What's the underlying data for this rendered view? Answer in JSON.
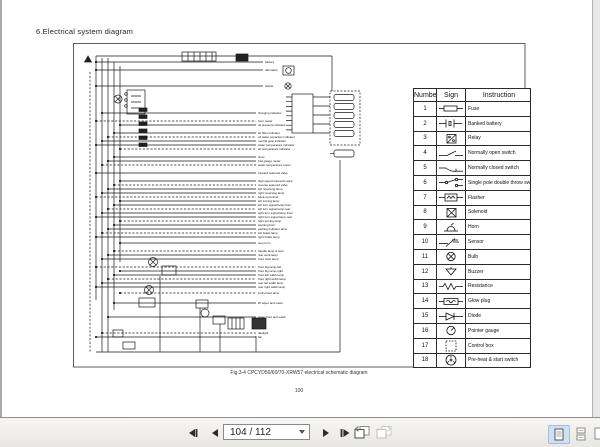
{
  "page": {
    "section_title": "6.Electrical system diagram",
    "caption": "Fig.3-4 CPCYD50/60/70-XRW57 electrical schematic diagram",
    "page_number": "100"
  },
  "diagram": {
    "labels": [
      "battery",
      "alternator",
      "starter",
      "charging indicator",
      "hour meter",
      "oil pressure indicator",
      "air filter indicator",
      "oil water separator indicator",
      "neutral gear indicator",
      "water temperature indicator",
      "air temperature indicator",
      "timer",
      "fuel gauge meter",
      "water temperature meter",
      "forward solenoid valve",
      "high speed solenoid valve",
      "reverse solenoid valve",
      "left reversing lamp",
      "right reversing lamp",
      "back-up buzzer",
      "left turning lamp",
      "left turn signal lamp-front",
      "left turn signal lamp-rear",
      "right turn signal lamp-front",
      "right turn signal lamp-rear",
      "right turning lamp",
      "warning horn",
      "parking indicator lamp",
      "left brake lamp",
      "right brake lamp",
      "stop horn",
      "handle lamp & horn",
      "rear work lamp",
      "front work lamp",
      "front big lamp-left",
      "front big lamp-right",
      "front left width lamp",
      "front right width lamp",
      "rear left width lamp",
      "rear right width lamp",
      "instrument lamp",
      "lift wiper and wash",
      "wiper front and wash",
      "daylight",
      "fan"
    ]
  },
  "table": {
    "headers": {
      "number": "Number",
      "sign": "Sign",
      "instruction": "Instruction"
    },
    "rows": [
      {
        "num": "1",
        "sign": "fuse-symbol",
        "instruction": "Fuse"
      },
      {
        "num": "2",
        "sign": "banked-battery-symbol",
        "instruction": "Banked battery"
      },
      {
        "num": "3",
        "sign": "relay-symbol",
        "instruction": "Relay"
      },
      {
        "num": "4",
        "sign": "normally-open-switch-symbol",
        "instruction": "Normally open switch"
      },
      {
        "num": "5",
        "sign": "normally-closed-switch-symbol",
        "instruction": "Normally closed switch"
      },
      {
        "num": "6",
        "sign": "single-pole-double-throw-switch-symbol",
        "instruction": "Single pole double throw switch"
      },
      {
        "num": "7",
        "sign": "flasher-symbol",
        "instruction": "Flasher"
      },
      {
        "num": "8",
        "sign": "solenoid-symbol",
        "instruction": "Solenoid"
      },
      {
        "num": "9",
        "sign": "horn-symbol",
        "instruction": "Horn"
      },
      {
        "num": "10",
        "sign": "sensor-symbol",
        "instruction": "Sensor"
      },
      {
        "num": "11",
        "sign": "bulb-symbol",
        "instruction": "Bulb"
      },
      {
        "num": "12",
        "sign": "buzzer-symbol",
        "instruction": "Buzzer"
      },
      {
        "num": "13",
        "sign": "resistance-symbol",
        "instruction": "Resistance"
      },
      {
        "num": "14",
        "sign": "glow-plug-symbol",
        "instruction": "Glow plug"
      },
      {
        "num": "15",
        "sign": "diode-symbol",
        "instruction": "Diode"
      },
      {
        "num": "16",
        "sign": "pointer-gauge-symbol",
        "instruction": "Pointer gauge"
      },
      {
        "num": "17",
        "sign": "control-box-symbol",
        "instruction": "Control box"
      },
      {
        "num": "18",
        "sign": "preheat-start-switch-symbol",
        "instruction": "Pre-heat & start switch"
      }
    ]
  },
  "toolbar": {
    "page_field": "104 / 112"
  },
  "colors": {
    "active_view_bg": "#cfe0f3",
    "toolbar_bg": "#f1efec"
  }
}
